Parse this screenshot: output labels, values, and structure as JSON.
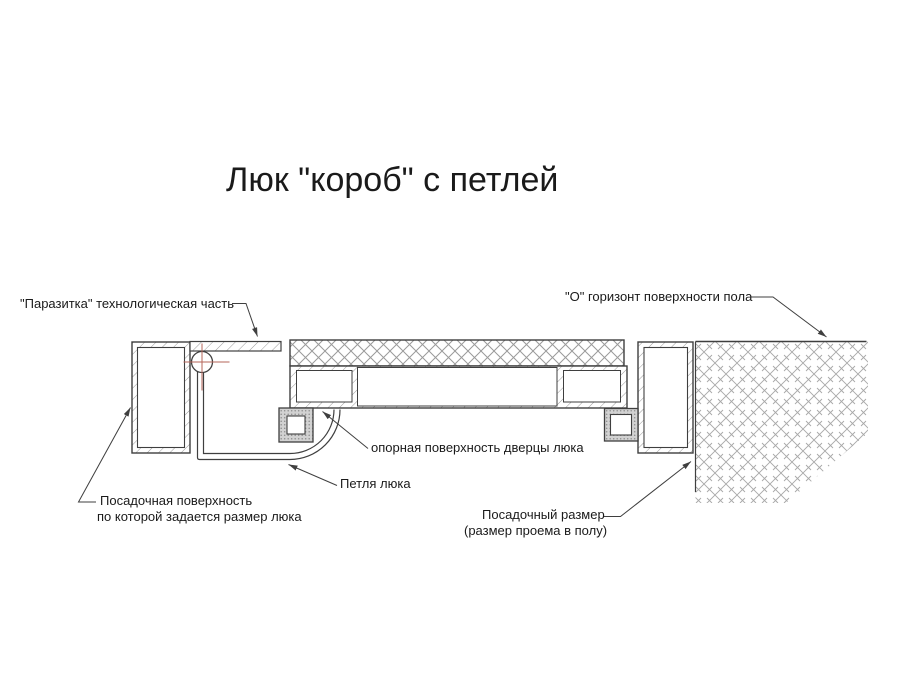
{
  "title": "Люк \"короб\" с петлей",
  "drawing": {
    "labels": {
      "parasitka": "\"Паразитка\" технологическая часть",
      "floor_horizon": "\"О\" горизонт поверхности пола",
      "door_support": "опорная поверхность дверцы люка",
      "hinge": "Петля люка",
      "seating_surface": [
        "Посадочная поверхность",
        "по которой задается размер люка"
      ],
      "seating_size": [
        "Посадочный размер",
        "(размер проема в полу)"
      ]
    },
    "colors": {
      "background": "#ffffff",
      "text": "#1a1a1a",
      "line": "#3f3f3f",
      "hatch": "#9a9a9a",
      "ground_hatch": "#a8a8a8",
      "centerline": "#b5655a",
      "block_fill": "#d2d2d2",
      "block_dot": "#8c8c8c"
    }
  }
}
